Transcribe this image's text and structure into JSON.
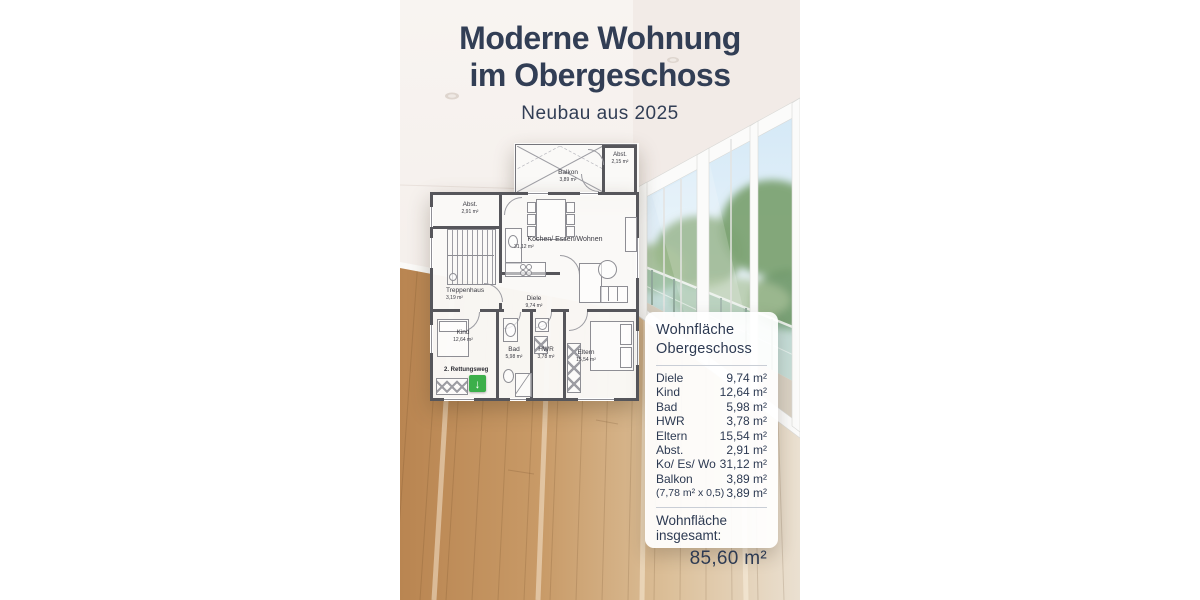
{
  "header": {
    "title_line1": "Moderne Wohnung",
    "title_line2": "im Obergeschoss",
    "subtitle": "Neubau aus 2025",
    "title_color": "#323e55"
  },
  "floorplan": {
    "rooms": [
      {
        "name": "Balkon",
        "area": "3,89 m²"
      },
      {
        "name": "Abst.",
        "area": "2,15 m²"
      },
      {
        "name": "Abst.",
        "area": "2,91 m²"
      },
      {
        "name": "Treppenhaus",
        "area": "3,19 m²"
      },
      {
        "name": "Kochen/ Essen/Wohnen",
        "area": "31,12 m²"
      },
      {
        "name": "Diele",
        "area": "9,74 m²"
      },
      {
        "name": "Kind",
        "area": "12,64 m²"
      },
      {
        "name": "Bad",
        "area": "5,98 m²"
      },
      {
        "name": "HWR",
        "area": "3,78 m²"
      },
      {
        "name": "Eltern",
        "area": "15,54 m²"
      }
    ],
    "escape_route_label": "2. Rettungsweg",
    "escape_arrow": "↓",
    "accent_green": "#3caf4a"
  },
  "area_panel": {
    "title_line1": "Wohnfläche",
    "title_line2": "Obergeschoss",
    "rows": [
      {
        "label": "Diele",
        "value": "9,74 m²"
      },
      {
        "label": "Kind",
        "value": "12,64 m²"
      },
      {
        "label": "Bad",
        "value": "5,98 m²"
      },
      {
        "label": "HWR",
        "value": "3,78 m²"
      },
      {
        "label": "Eltern",
        "value": "15,54 m²"
      },
      {
        "label": "Abst.",
        "value": "2,91 m²"
      },
      {
        "label": "Ko/ Es/ Wo",
        "value": "31,12 m²"
      },
      {
        "label": "Balkon",
        "value": "3,89 m²"
      },
      {
        "label": "(7,78 m² x 0,5)",
        "value": "3,89 m²"
      }
    ],
    "total_label": "Wohnfläche insgesamt:",
    "total_value": "85,60 m²",
    "text_color": "#2d3a52"
  }
}
